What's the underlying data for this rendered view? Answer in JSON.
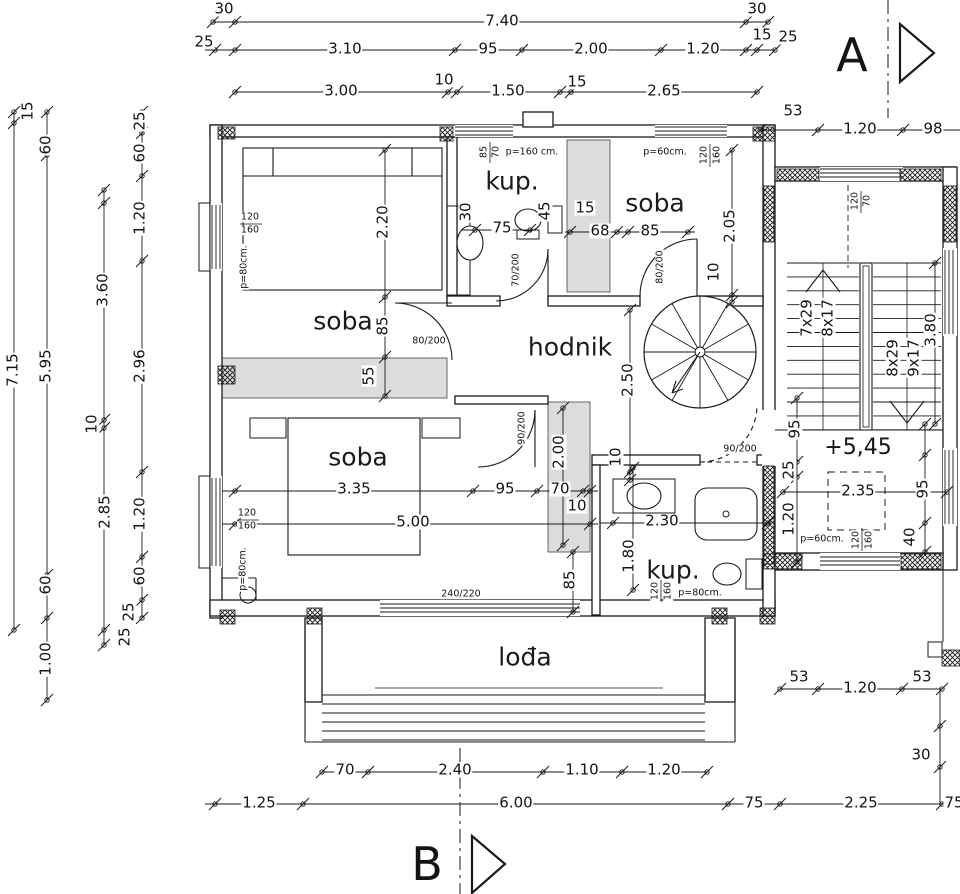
{
  "drawing": {
    "type": "architectural floor plan",
    "section_markers": [
      "A",
      "B"
    ],
    "level_mark": "+5,45",
    "room_names": [
      "soba",
      "soba",
      "soba",
      "kup.",
      "kup.",
      "hodnik",
      "lođa"
    ],
    "stair_flights": [
      "7x29",
      "8x17",
      "8x29",
      "9x17"
    ],
    "line_color": "#1a1a1a",
    "shade_color": "#dcdcdc"
  },
  "labels": [
    {
      "t": "30",
      "x": 224,
      "y": 9,
      "k": "dim"
    },
    {
      "t": "7.40",
      "x": 502,
      "y": 21,
      "k": "dim"
    },
    {
      "t": "30",
      "x": 757,
      "y": 9,
      "k": "dim"
    },
    {
      "t": "25",
      "x": 204,
      "y": 42,
      "k": "dim"
    },
    {
      "t": "3.10",
      "x": 345,
      "y": 49,
      "k": "dim"
    },
    {
      "t": "95",
      "x": 488,
      "y": 49,
      "k": "dim"
    },
    {
      "t": "2.00",
      "x": 591,
      "y": 49,
      "k": "dim"
    },
    {
      "t": "1.20",
      "x": 703,
      "y": 49,
      "k": "dim"
    },
    {
      "t": "15",
      "x": 762,
      "y": 35,
      "k": "dim"
    },
    {
      "t": "25",
      "x": 788,
      "y": 37,
      "k": "dim"
    },
    {
      "t": "3.00",
      "x": 341,
      "y": 91,
      "k": "dim"
    },
    {
      "t": "10",
      "x": 444,
      "y": 80,
      "k": "dim"
    },
    {
      "t": "1.50",
      "x": 508,
      "y": 91,
      "k": "dim"
    },
    {
      "t": "15",
      "x": 577,
      "y": 82,
      "k": "dim"
    },
    {
      "t": "2.65",
      "x": 664,
      "y": 91,
      "k": "dim"
    },
    {
      "t": "53",
      "x": 793,
      "y": 111,
      "k": "dim"
    },
    {
      "t": "1.20",
      "x": 860,
      "y": 129,
      "k": "dim"
    },
    {
      "t": "98",
      "x": 933,
      "y": 129,
      "k": "dim"
    },
    {
      "t": "15",
      "x": 28,
      "y": 111,
      "k": "dim",
      "r": 1
    },
    {
      "t": "7.15",
      "x": 13,
      "y": 370,
      "k": "dim",
      "r": 1
    },
    {
      "t": "60",
      "x": 46,
      "y": 145,
      "k": "dim",
      "r": 1
    },
    {
      "t": "5.95",
      "x": 46,
      "y": 366,
      "k": "dim",
      "r": 1
    },
    {
      "t": "60",
      "x": 46,
      "y": 585,
      "k": "dim",
      "r": 1
    },
    {
      "t": "1.00",
      "x": 46,
      "y": 659,
      "k": "dim",
      "r": 1
    },
    {
      "t": "3.60",
      "x": 103,
      "y": 290,
      "k": "dim",
      "r": 1
    },
    {
      "t": "10",
      "x": 92,
      "y": 424,
      "k": "dim",
      "r": 1
    },
    {
      "t": "2.85",
      "x": 105,
      "y": 512,
      "k": "dim",
      "r": 1
    },
    {
      "t": "25",
      "x": 125,
      "y": 637,
      "k": "dim",
      "r": 1
    },
    {
      "t": "25",
      "x": 140,
      "y": 121,
      "k": "dim",
      "r": 1
    },
    {
      "t": "60",
      "x": 140,
      "y": 153,
      "k": "dim",
      "r": 1
    },
    {
      "t": "1.20",
      "x": 140,
      "y": 218,
      "k": "dim",
      "r": 1
    },
    {
      "t": "2.96",
      "x": 140,
      "y": 366,
      "k": "dim",
      "r": 1
    },
    {
      "t": "1.20",
      "x": 140,
      "y": 514,
      "k": "dim",
      "r": 1
    },
    {
      "t": "60",
      "x": 140,
      "y": 576,
      "k": "dim",
      "r": 1
    },
    {
      "t": "25",
      "x": 129,
      "y": 612,
      "k": "dim",
      "r": 1
    },
    {
      "t": "2.20",
      "x": 383,
      "y": 222,
      "k": "dim",
      "r": 1
    },
    {
      "t": "85",
      "x": 383,
      "y": 326,
      "k": "dim",
      "r": 1
    },
    {
      "t": "55",
      "x": 369,
      "y": 376,
      "k": "dim",
      "r": 1
    },
    {
      "t": "2.05",
      "x": 730,
      "y": 226,
      "k": "dim",
      "r": 1
    },
    {
      "t": "10",
      "x": 714,
      "y": 272,
      "k": "dim",
      "r": 1
    },
    {
      "t": "2.50",
      "x": 628,
      "y": 380,
      "k": "dim",
      "r": 1
    },
    {
      "t": "10",
      "x": 616,
      "y": 457,
      "k": "dim",
      "r": 1
    },
    {
      "t": "2.00",
      "x": 559,
      "y": 452,
      "k": "dim",
      "r": 1
    },
    {
      "t": "85",
      "x": 570,
      "y": 580,
      "k": "dim",
      "r": 1
    },
    {
      "t": "1.80",
      "x": 629,
      "y": 556,
      "k": "dim",
      "r": 1
    },
    {
      "t": "75",
      "x": 502,
      "y": 228,
      "k": "dim"
    },
    {
      "t": "30",
      "x": 466,
      "y": 212,
      "k": "dim",
      "r": 1
    },
    {
      "t": "45",
      "x": 545,
      "y": 211,
      "k": "dim",
      "r": 1
    },
    {
      "t": "15",
      "x": 585,
      "y": 208,
      "k": "dim"
    },
    {
      "t": "68",
      "x": 600,
      "y": 231,
      "k": "dim"
    },
    {
      "t": "85",
      "x": 650,
      "y": 231,
      "k": "dim"
    },
    {
      "t": "3.35",
      "x": 354,
      "y": 489,
      "k": "dim"
    },
    {
      "t": "95",
      "x": 505,
      "y": 489,
      "k": "dim"
    },
    {
      "t": "70",
      "x": 560,
      "y": 489,
      "k": "dim"
    },
    {
      "t": "10",
      "x": 577,
      "y": 506,
      "k": "dim"
    },
    {
      "t": "5.00",
      "x": 413,
      "y": 522,
      "k": "dim"
    },
    {
      "t": "2.30",
      "x": 662,
      "y": 521,
      "k": "dim"
    },
    {
      "t": "95",
      "x": 795,
      "y": 429,
      "k": "dim",
      "r": 1
    },
    {
      "t": "25",
      "x": 789,
      "y": 470,
      "k": "dim",
      "r": 1
    },
    {
      "t": "1.20",
      "x": 789,
      "y": 519,
      "k": "dim",
      "r": 1
    },
    {
      "t": "95",
      "x": 923,
      "y": 489,
      "k": "dim",
      "r": 1
    },
    {
      "t": "40",
      "x": 910,
      "y": 537,
      "k": "dim",
      "r": 1
    },
    {
      "t": "3.80",
      "x": 931,
      "y": 330,
      "k": "dim",
      "r": 1
    },
    {
      "t": "2.35",
      "x": 858,
      "y": 491,
      "k": "dim"
    },
    {
      "t": "53",
      "x": 799,
      "y": 677,
      "k": "dim"
    },
    {
      "t": "1.20",
      "x": 860,
      "y": 688,
      "k": "dim"
    },
    {
      "t": "53",
      "x": 922,
      "y": 677,
      "k": "dim"
    },
    {
      "t": "30",
      "x": 921,
      "y": 755,
      "k": "dim"
    },
    {
      "t": "70",
      "x": 345,
      "y": 770,
      "k": "dim"
    },
    {
      "t": "2.40",
      "x": 455,
      "y": 770,
      "k": "dim"
    },
    {
      "t": "1.10",
      "x": 582,
      "y": 770,
      "k": "dim"
    },
    {
      "t": "1.20",
      "x": 664,
      "y": 770,
      "k": "dim"
    },
    {
      "t": "1.25",
      "x": 259,
      "y": 803,
      "k": "dim"
    },
    {
      "t": "6.00",
      "x": 516,
      "y": 803,
      "k": "dim"
    },
    {
      "t": "75",
      "x": 754,
      "y": 803,
      "k": "dim"
    },
    {
      "t": "2.25",
      "x": 861,
      "y": 803,
      "k": "dim"
    },
    {
      "t": "75",
      "x": 954,
      "y": 803,
      "k": "dim"
    },
    {
      "t": "7x29",
      "x": 807,
      "y": 318,
      "k": "dim",
      "r": 1
    },
    {
      "t": "8x17",
      "x": 828,
      "y": 318,
      "k": "dim",
      "r": 1
    },
    {
      "t": "8x29",
      "x": 893,
      "y": 358,
      "k": "dim",
      "r": 1
    },
    {
      "t": "9x17",
      "x": 914,
      "y": 358,
      "k": "dim",
      "r": 1
    },
    {
      "t": "p=160 cm.",
      "x": 532,
      "y": 152,
      "k": "note"
    },
    {
      "t": "85",
      "x": 484,
      "y": 152,
      "k": "note",
      "r": 1
    },
    {
      "t": "70",
      "x": 496,
      "y": 152,
      "k": "note",
      "r": 1
    },
    {
      "t": "p=60cm.",
      "x": 665,
      "y": 152,
      "k": "note"
    },
    {
      "t": "120",
      "x": 704,
      "y": 155,
      "k": "note",
      "r": 1
    },
    {
      "t": "160",
      "x": 717,
      "y": 155,
      "k": "note",
      "r": 1
    },
    {
      "t": "120",
      "x": 855,
      "y": 201,
      "k": "note",
      "r": 1
    },
    {
      "t": "70",
      "x": 867,
      "y": 201,
      "k": "note",
      "r": 1
    },
    {
      "t": "120",
      "x": 250,
      "y": 217,
      "k": "note"
    },
    {
      "t": "160",
      "x": 250,
      "y": 230,
      "k": "note"
    },
    {
      "t": "p=80cm.",
      "x": 244,
      "y": 267,
      "k": "note",
      "r": 1
    },
    {
      "t": "120",
      "x": 247,
      "y": 513,
      "k": "note"
    },
    {
      "t": "160",
      "x": 247,
      "y": 526,
      "k": "note"
    },
    {
      "t": "p=80cm.",
      "x": 243,
      "y": 569,
      "k": "note",
      "r": 1
    },
    {
      "t": "120",
      "x": 655,
      "y": 591,
      "k": "note",
      "r": 1
    },
    {
      "t": "160",
      "x": 668,
      "y": 591,
      "k": "note",
      "r": 1
    },
    {
      "t": "p=80cm.",
      "x": 700,
      "y": 593,
      "k": "note"
    },
    {
      "t": "120",
      "x": 856,
      "y": 540,
      "k": "note",
      "r": 1
    },
    {
      "t": "160",
      "x": 869,
      "y": 540,
      "k": "note",
      "r": 1
    },
    {
      "t": "p=60cm.",
      "x": 822,
      "y": 539,
      "k": "note"
    },
    {
      "t": "70/200",
      "x": 516,
      "y": 270,
      "k": "note",
      "r": 1
    },
    {
      "t": "80/200",
      "x": 429,
      "y": 341,
      "k": "note"
    },
    {
      "t": "80/200",
      "x": 660,
      "y": 267,
      "k": "note",
      "r": 1
    },
    {
      "t": "90/200",
      "x": 522,
      "y": 428,
      "k": "note",
      "r": 1
    },
    {
      "t": "90/200",
      "x": 740,
      "y": 449,
      "k": "note"
    },
    {
      "t": "240/220",
      "x": 461,
      "y": 594,
      "k": "note"
    },
    {
      "t": "soba",
      "x": 343,
      "y": 321,
      "k": "room"
    },
    {
      "t": "soba",
      "x": 655,
      "y": 203,
      "k": "room"
    },
    {
      "t": "soba",
      "x": 358,
      "y": 457,
      "k": "room"
    },
    {
      "t": "kup.",
      "x": 512,
      "y": 181,
      "k": "room"
    },
    {
      "t": "kup.",
      "x": 673,
      "y": 570,
      "k": "room"
    },
    {
      "t": "hodnik",
      "x": 570,
      "y": 347,
      "k": "room"
    },
    {
      "t": "lođa",
      "x": 525,
      "y": 657,
      "k": "room"
    },
    {
      "t": "+5,45",
      "x": 858,
      "y": 448,
      "k": "level"
    },
    {
      "t": "A",
      "x": 852,
      "y": 55,
      "k": "marker"
    },
    {
      "t": "B",
      "x": 427,
      "y": 864,
      "k": "marker"
    }
  ]
}
